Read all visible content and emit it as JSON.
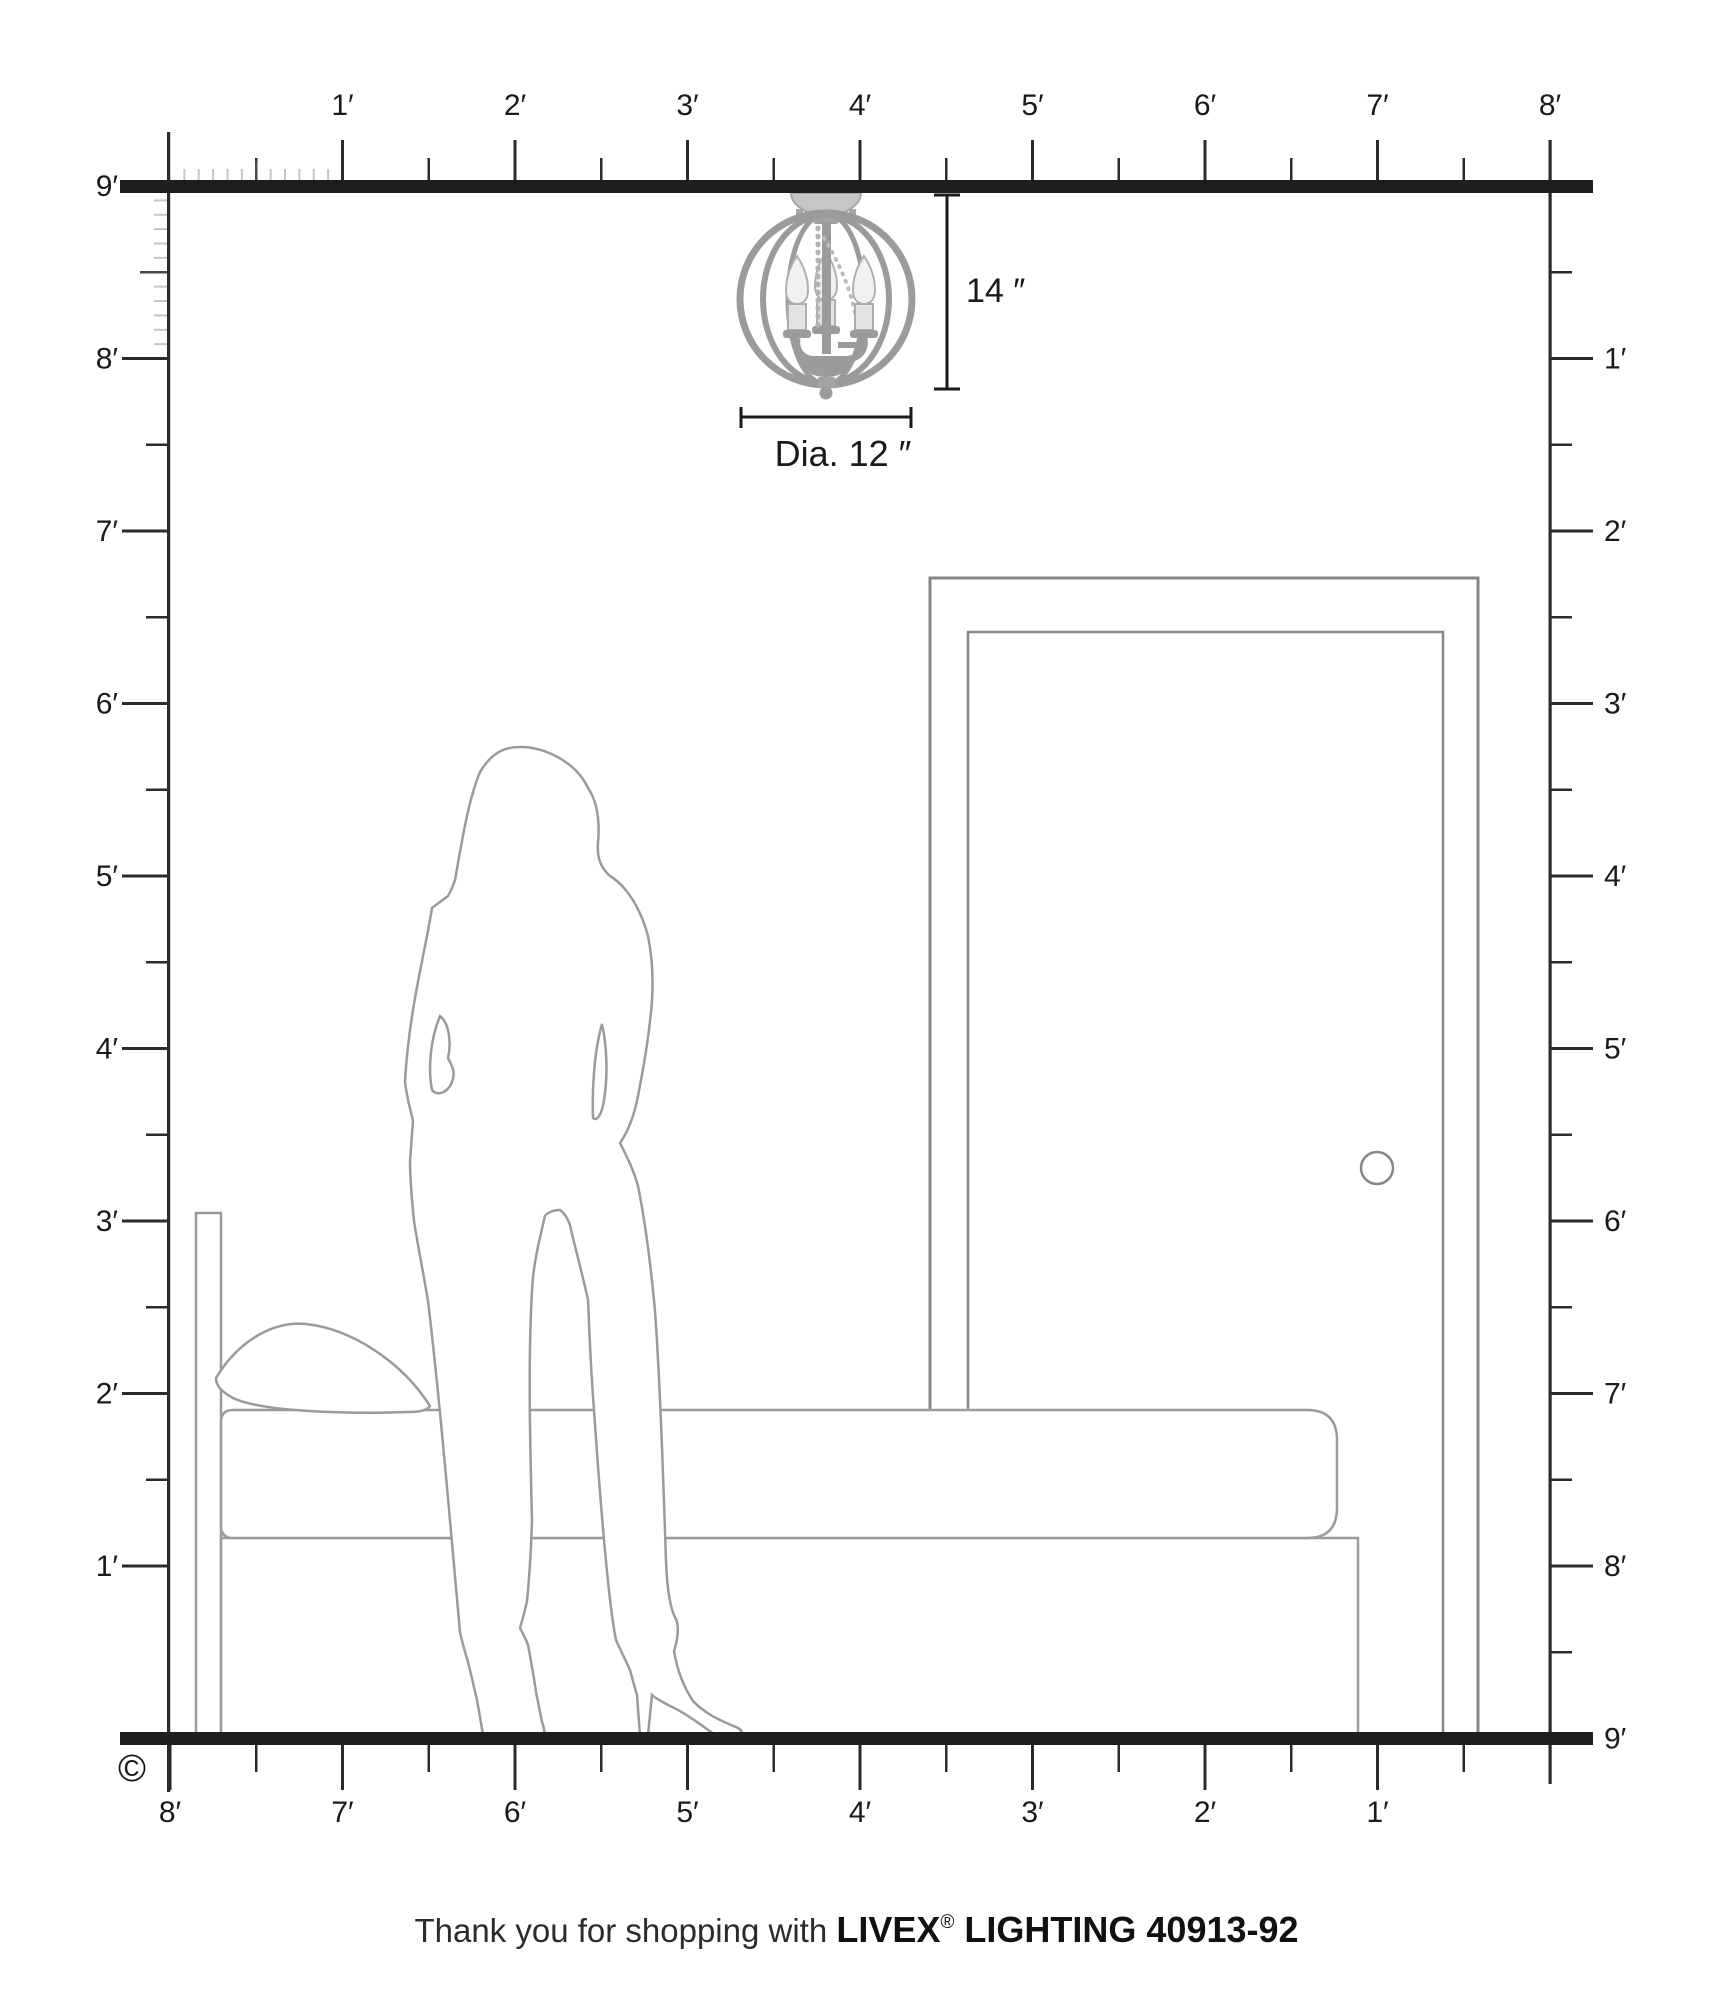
{
  "title": "Livex Lighting fixture mounting-scale diagram",
  "scale": {
    "px_per_foot": 172.5,
    "origin_x": 170,
    "ceiling_y": 186,
    "right_x": 1550,
    "feet_wide": 8,
    "feet_high": 9
  },
  "rulers": {
    "top": {
      "labels": [
        "1′",
        "2′",
        "3′",
        "4′",
        "5′",
        "6′",
        "7′",
        "8′"
      ]
    },
    "left": {
      "labels": [
        "9′",
        "8′",
        "7′",
        "6′",
        "5′",
        "4′",
        "3′",
        "2′",
        "1′"
      ]
    },
    "right": {
      "labels": [
        "1′",
        "2′",
        "3′",
        "4′",
        "5′",
        "6′",
        "7′",
        "8′",
        "9′"
      ]
    },
    "bottom": {
      "labels": [
        "8′",
        "7′",
        "6′",
        "5′",
        "4′",
        "3′",
        "2′",
        "1′"
      ]
    }
  },
  "dimensions": {
    "height_label": "14 ″",
    "diameter_label": "Dia. 12 ″"
  },
  "copyright": "©",
  "footer": {
    "prefix": "Thank you for shopping with ",
    "brand": "LIVEX",
    "reg": "®",
    "suffix": " LIGHTING 40913-92"
  },
  "colors": {
    "ink": "#1a1a1a",
    "ruler_dark": "#2b2b2b",
    "ruler_mid": "#4a4a4a",
    "ruler_light": "#c6c6c6",
    "drawing_gray": "#9b9b9b",
    "door_gray": "#878787",
    "fixture_metal": "#9b9b9b",
    "fixture_canopy": "#c6c6c6",
    "bulb_fill": "#f1f1f1"
  }
}
